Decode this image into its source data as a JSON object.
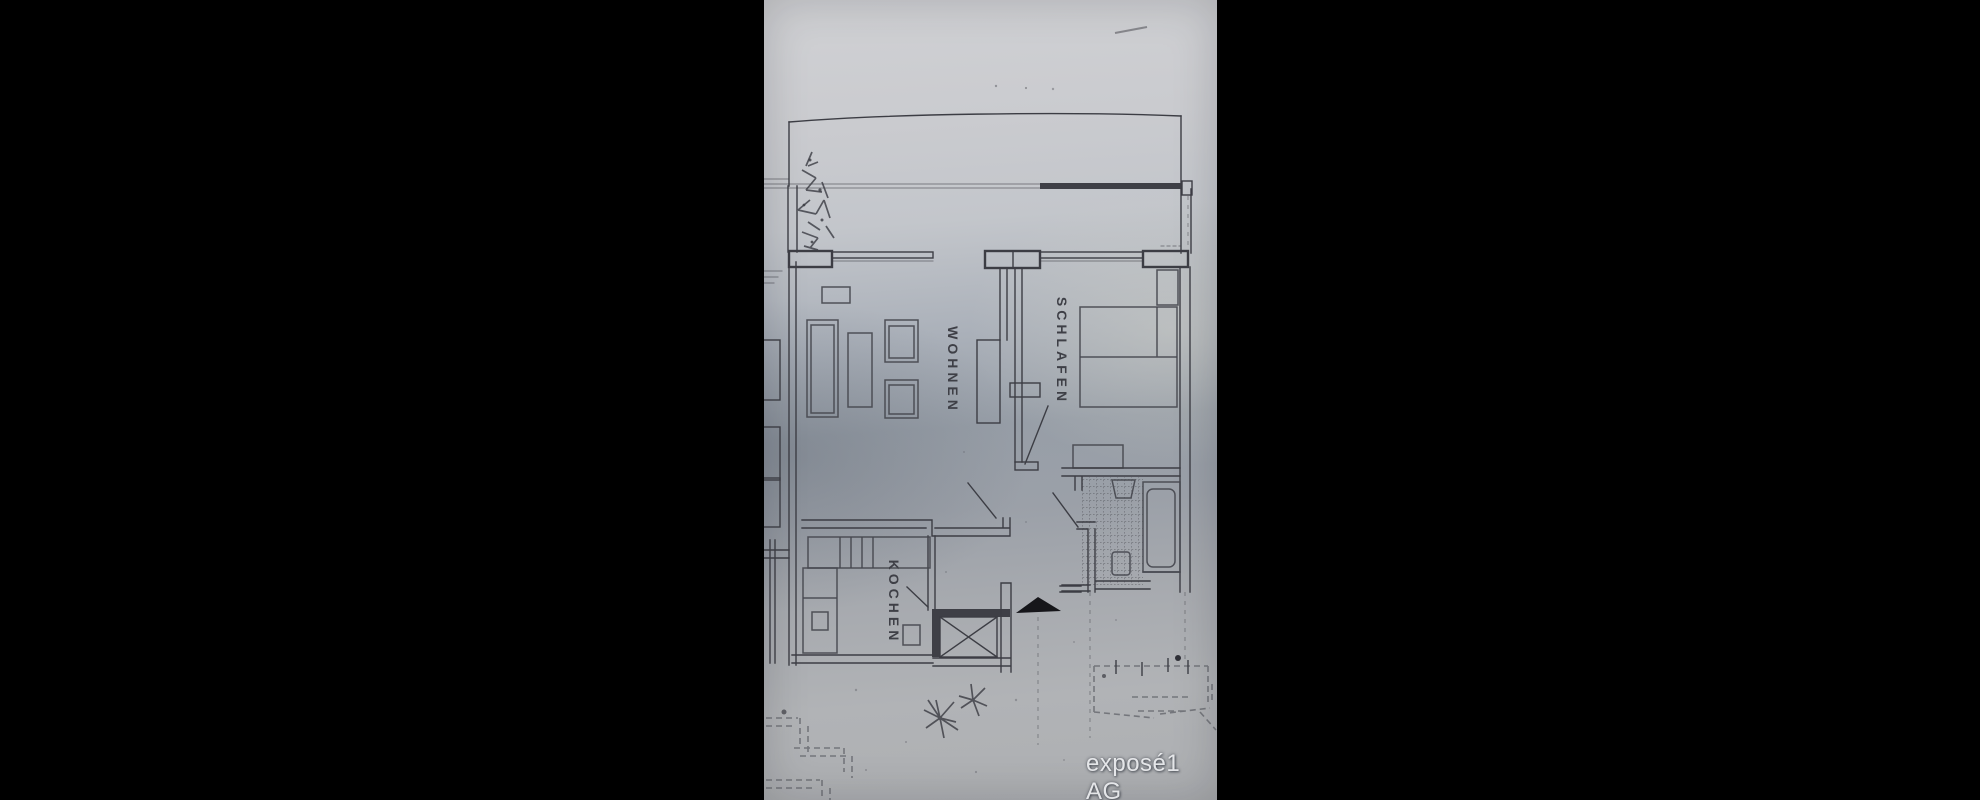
{
  "scene": {
    "background_color": "#000000",
    "paper_tone_top": "#d0d1d4",
    "paper_tone_middle": "#979ea7",
    "paper_tone_bottom": "#adafb2",
    "ink_color": "#3c3d44"
  },
  "floorplan": {
    "type": "apartment-floor-plan",
    "rooms": [
      {
        "id": "wohnen",
        "label": "WOHNEN"
      },
      {
        "id": "schlafen",
        "label": "SCHLAFEN"
      },
      {
        "id": "kochen",
        "label": "KOCHEN"
      }
    ],
    "unlabeled_features": [
      "balcony",
      "bathroom",
      "hallway",
      "elevator-shaft",
      "entrance-arrow",
      "neighbor-unit-fragment",
      "garden-sketches",
      "plant-sketch"
    ],
    "watermark": "exposé1 AG"
  }
}
